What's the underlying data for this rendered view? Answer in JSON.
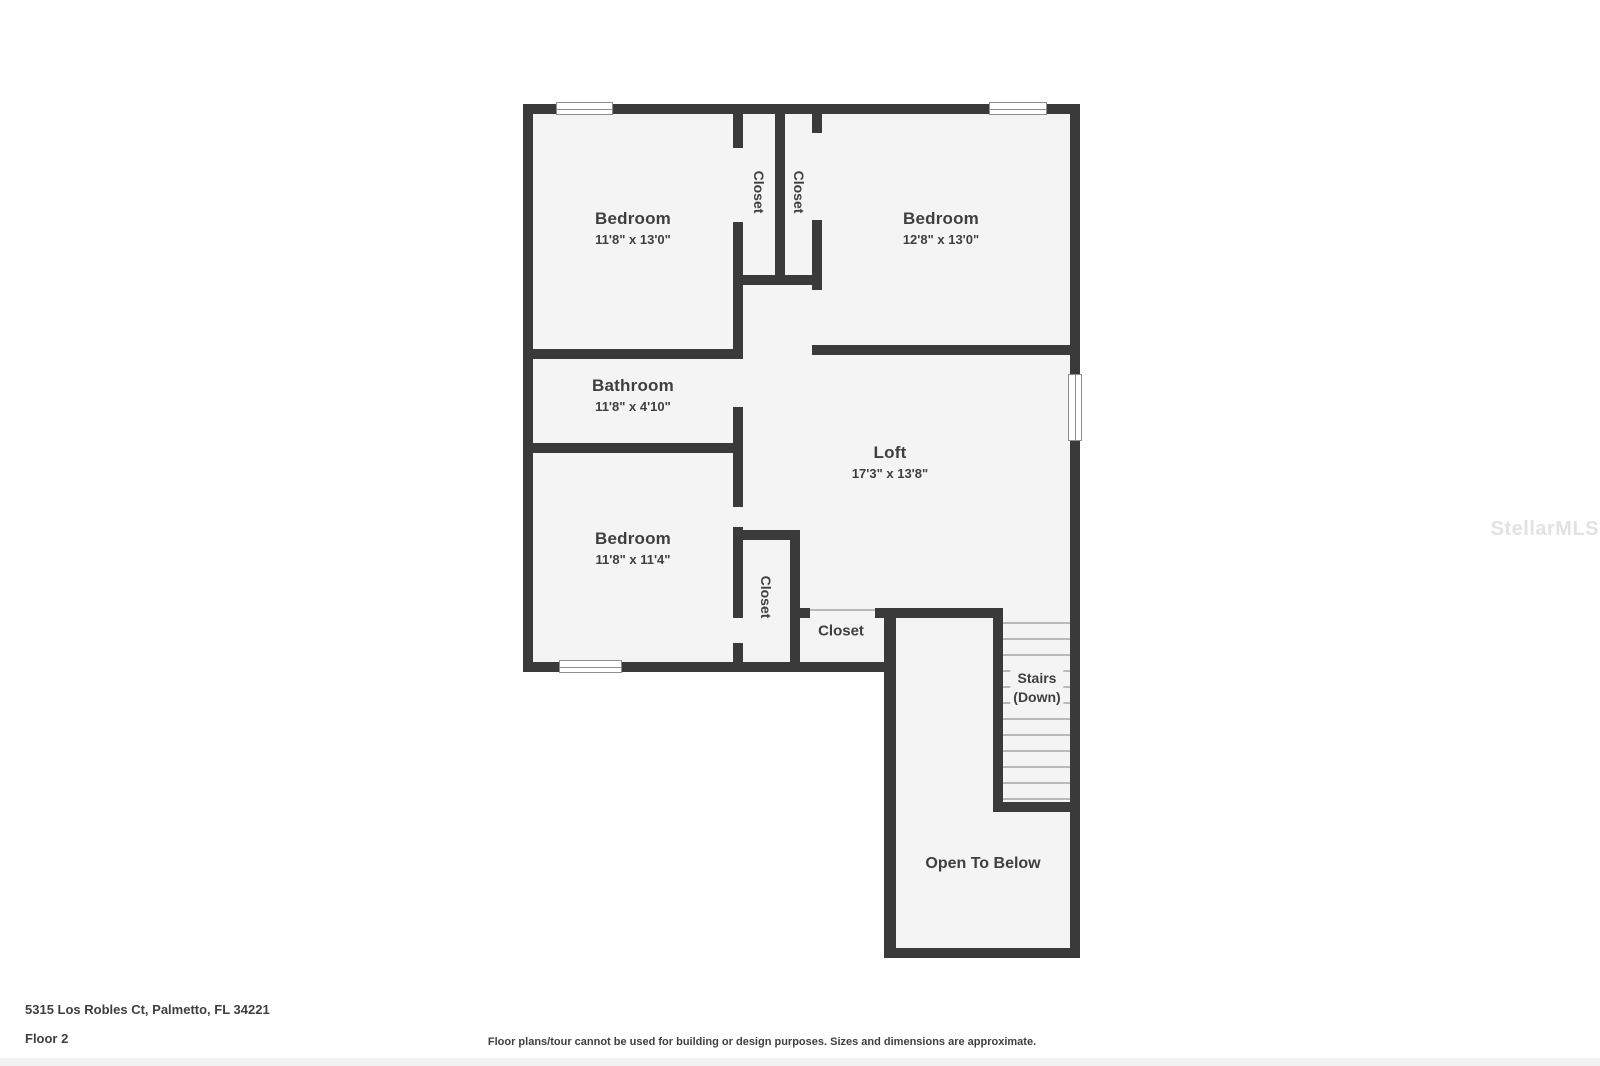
{
  "rooms": {
    "bedroom_tl": {
      "label": "Bedroom",
      "dims": "11'8\" x 13'0\""
    },
    "bedroom_tr": {
      "label": "Bedroom",
      "dims": "12'8\" x 13'0\""
    },
    "bathroom": {
      "label": "Bathroom",
      "dims": "11'8\" x 4'10\""
    },
    "loft": {
      "label": "Loft",
      "dims": "17'3\" x 13'8\""
    },
    "bedroom_bl": {
      "label": "Bedroom",
      "dims": "11'8\" x 11'4\""
    },
    "closet_top_left": {
      "label": "Closet"
    },
    "closet_top_right": {
      "label": "Closet"
    },
    "closet_bottom_vertical": {
      "label": "Closet"
    },
    "closet_bottom": {
      "label": "Closet"
    },
    "stairs": {
      "line1": "Stairs",
      "line2": "(Down)"
    },
    "open_to_below": {
      "label": "Open To Below"
    }
  },
  "footer": {
    "address": "5315 Los Robles Ct, Palmetto, FL 34221",
    "floor": "Floor 2",
    "disclaimer": "Floor plans/tour cannot be used for building or design purposes. Sizes and dimensions are approximate."
  },
  "watermark": "StellarMLS",
  "colors": {
    "wall": "#3a3a3a",
    "room_fill": "#f4f4f4",
    "text": "#3f3f3f",
    "watermark": "#e2e2e2",
    "tread": "#b8b8b8",
    "window_frame": "#8e8e8e"
  }
}
